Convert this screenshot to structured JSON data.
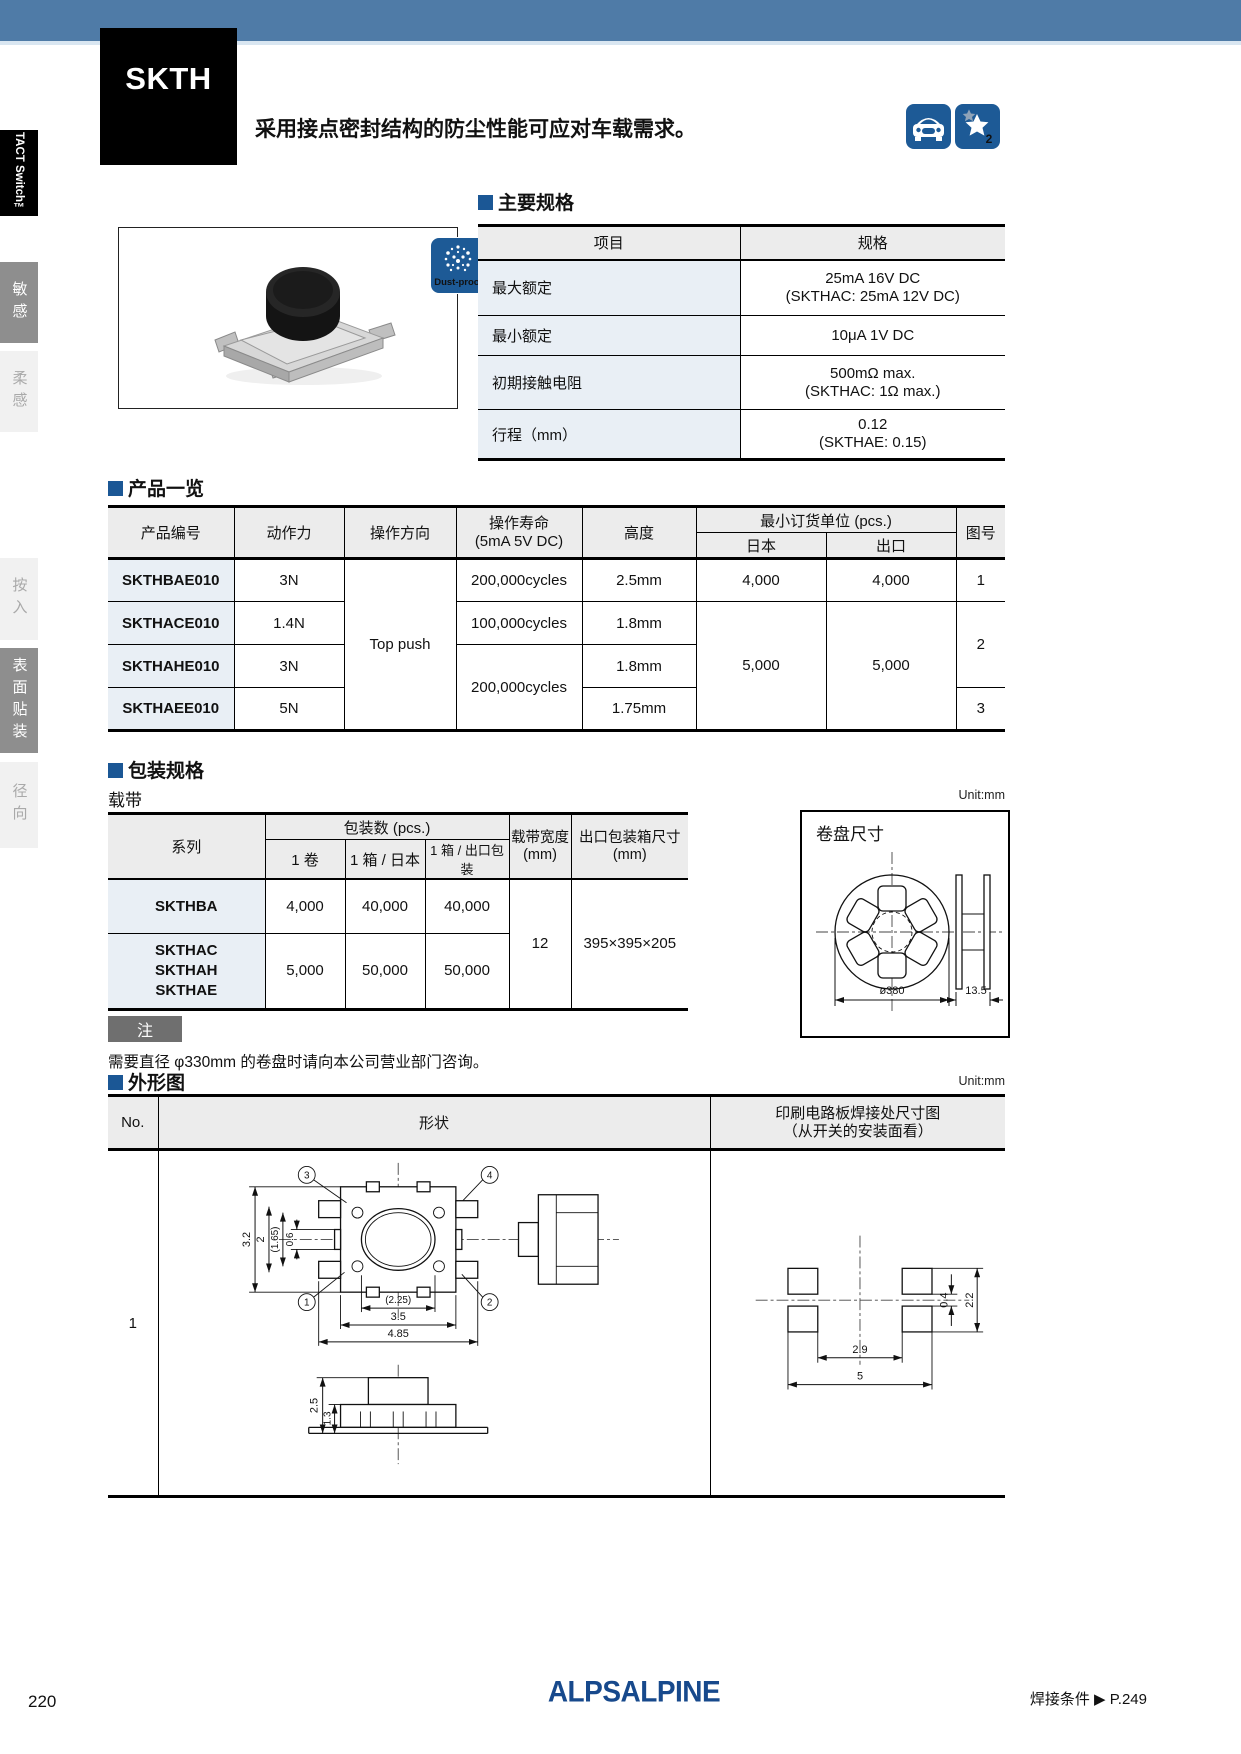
{
  "colors": {
    "banner_blue": "#4f7ba7",
    "band_light": "#d9e6f1",
    "accent_blue": "#1b5795",
    "icon_blue": "#1d5a96",
    "logo_blue": "#17498c"
  },
  "sidebar": {
    "tab_title": "TACT Switch™",
    "items": [
      {
        "label": "敏感"
      },
      {
        "label": "柔感"
      },
      {
        "label": "按入"
      },
      {
        "label": "表面贴装"
      },
      {
        "label": "径向"
      }
    ]
  },
  "header": {
    "series": "SKTH",
    "title": "3.5×3.2mm小型防尘型（表面贴装）",
    "subtitle": "采用接点密封结构的防尘性能可应对车载需求。",
    "car_icon": "car-icon",
    "star_icon": "star-2-icon",
    "star_number": "2"
  },
  "photo": {
    "dustproof_badge": "Dust-proof"
  },
  "specs": {
    "heading": "主要规格",
    "columns": {
      "item": "项目",
      "spec": "规格"
    },
    "rows": [
      {
        "item": "最大额定",
        "value": "25mA 16V DC",
        "note": "(SKTHAC: 25mA 12V DC)"
      },
      {
        "item": "最小额定",
        "value": "10μA 1V DC",
        "note": ""
      },
      {
        "item": "初期接触电阻",
        "value": "500mΩ max.",
        "note": "(SKTHAC: 1Ω max.)"
      },
      {
        "item": "行程（mm）",
        "value": "0.12",
        "note": "(SKTHAE: 0.15)"
      }
    ]
  },
  "products": {
    "heading": "产品一览",
    "columns": {
      "part": "产品编号",
      "force": "动作力",
      "direction": "操作方向",
      "life1": "操作寿命",
      "life2": "(5mA 5V DC)",
      "height": "高度",
      "moq": "最小订货单位 (pcs.)",
      "japan": "日本",
      "export": "出口",
      "fig": "图号"
    },
    "direction_value": "Top push",
    "rows": [
      {
        "part": "SKTHBAE010",
        "force": "3N",
        "life": "200,000cycles",
        "height": "2.5mm",
        "japan": "4,000",
        "export": "4,000",
        "fig": "1"
      },
      {
        "part": "SKTHACE010",
        "force": "1.4N",
        "life": "100,000cycles",
        "height": "1.8mm",
        "japan": "5,000",
        "export": "5,000",
        "fig": "2"
      },
      {
        "part": "SKTHAHE010",
        "force": "3N",
        "life": "200,000cycles",
        "height": "1.8mm"
      },
      {
        "part": "SKTHAEE010",
        "force": "5N",
        "height": "1.75mm",
        "fig": "3"
      }
    ]
  },
  "packaging": {
    "heading": "包装规格",
    "subheading": "载带",
    "unit": "Unit:mm",
    "columns": {
      "series": "系列",
      "qty": "包装数 (pcs.)",
      "reel": "1 卷",
      "box_japan": "1 箱 / 日本",
      "box_export": "1 箱 / 出口包装",
      "tape1": "载带宽度",
      "tape2": "(mm)",
      "carton1": "出口包装箱尺寸",
      "carton2": "(mm)"
    },
    "rows": [
      {
        "series_lines": [
          "SKTHBA"
        ],
        "reel": "4,000",
        "box_japan": "40,000",
        "box_export": "40,000"
      },
      {
        "series_lines": [
          "SKTHAC",
          "SKTHAH",
          "SKTHAE"
        ],
        "reel": "5,000",
        "box_japan": "50,000",
        "box_export": "50,000"
      }
    ],
    "tape_width": "12",
    "carton_size": "395×395×205",
    "note_label": "注",
    "note_text": "需要直径 φ330mm 的卷盘时请向本公司营业部门咨询。",
    "reel": {
      "title": "卷盘尺寸",
      "diameter": "ø380",
      "width": "13.5"
    }
  },
  "outline": {
    "heading": "外形图",
    "unit": "Unit:mm",
    "columns": {
      "no": "No.",
      "shape": "形状",
      "pcb1": "印刷电路板焊接处尺寸图",
      "pcb2": "（从开关的安装面看）"
    },
    "row_no": "1",
    "shape_dims": {
      "d32": "3.2",
      "d2": "2",
      "d165": "(1.65)",
      "d06": "0.6",
      "d225": "(2.25)",
      "d35": "3.5",
      "d485": "4.85",
      "d25": "2.5",
      "d13": "1.3",
      "c1": "1",
      "c2": "2",
      "c3": "3",
      "c4": "4"
    },
    "pcb_dims": {
      "d04": "0.4",
      "d22": "2.2",
      "d29": "2.9",
      "d5": "5"
    }
  },
  "footer": {
    "page": "220",
    "logo": "ALPSALPINE",
    "link": "焊接条件 ▶ P.249"
  }
}
